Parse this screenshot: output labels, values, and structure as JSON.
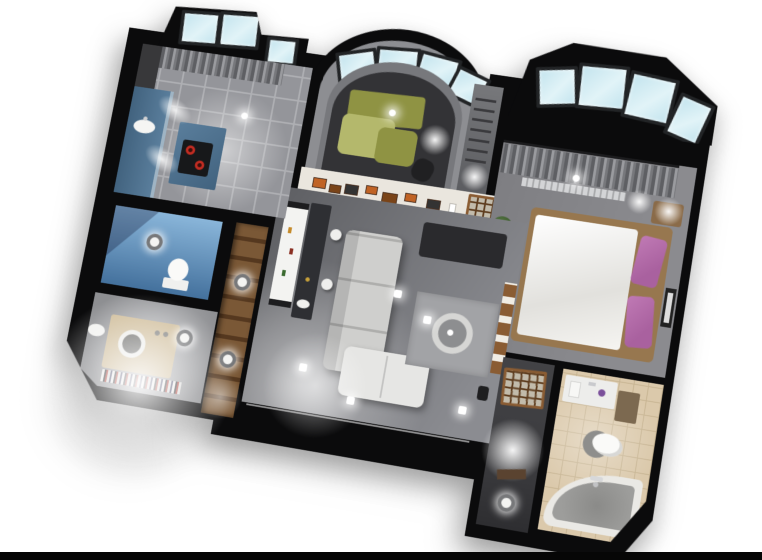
{
  "scene": {
    "type": "3d-apartment-floorplan-render",
    "view": "tilted top-down cutaway",
    "rooms": [
      {
        "id": "kitchen",
        "objects": [
          "window-bay",
          "curtain",
          "blue-cabinets",
          "counter",
          "cooktop-red-burners",
          "sink",
          "tile-floor",
          "ceiling-light"
        ]
      },
      {
        "id": "lounge-bay-room",
        "objects": [
          "curved-bay-window",
          "olive-sofa",
          "desk-chair",
          "lamp",
          "dark-floor"
        ]
      },
      {
        "id": "living-room",
        "objects": [
          "white-credenza",
          "bar-counter",
          "stools",
          "gray-corner-sofa",
          "charcoal-daybed",
          "rug",
          "round-table",
          "shoji-door",
          "art-frames-wall",
          "shelf-unit",
          "ceiling-spotlights"
        ]
      },
      {
        "id": "bedroom",
        "objects": [
          "trapezoid-bay-window",
          "curtain",
          "double-bed",
          "purple-pillows",
          "nightstand",
          "lamp",
          "plant",
          "wall-picture",
          "radiator"
        ]
      },
      {
        "id": "shower-room",
        "objects": [
          "blue-tiled-walls",
          "toilet",
          "ceiling-ring-light"
        ]
      },
      {
        "id": "laundry-room",
        "objects": [
          "washing-machine",
          "sink",
          "shelf-with-items",
          "ceiling-ring-light"
        ]
      },
      {
        "id": "wardrobe-hall",
        "objects": [
          "wood-shelving",
          "ceiling-ring-lights"
        ]
      },
      {
        "id": "bathroom",
        "objects": [
          "vanity-unit",
          "cabinet",
          "toilet",
          "round-mat",
          "corner-bathtub",
          "faucet",
          "beige-tile-floor"
        ]
      },
      {
        "id": "bathroom-hallway",
        "objects": [
          "shoji-screen",
          "dark-floor",
          "light-pool"
        ]
      }
    ]
  },
  "palette": {
    "bg": "#ffffff",
    "wall": "#0b0b0c",
    "glass": "#c3e4ee",
    "glass-frame": "#222426",
    "lounge-wall": "#8d8e92",
    "lounge-floor": "#333336",
    "kitchen-floor": "#94959a",
    "kitchen-grout": "#aeafb3",
    "cabinet-blue": "#5a7e9c",
    "cabinet-blue-dark": "#42637f",
    "counter-dark": "#2e2f33",
    "curtain-a": "#5e5f63",
    "curtain-b": "#9a9b9f",
    "sofa-olive": "#8f9343",
    "sofa-olive-light": "#b4b86c",
    "white-wall": "#eae6de",
    "art-orange": "#c06325",
    "art-brown": "#7a4418",
    "wood": "#8a5c33",
    "wood-dark": "#5e3d1f",
    "shoji-paper": "#c2bbab",
    "living-floor": "#5e5f63",
    "living-floor-light": "#8b8c91",
    "sofa-gray": "#cfcfcd",
    "sofa-gray-light": "#e6e6e4",
    "daybed": "#2a2a2d",
    "rug": "#a2a3a6",
    "bedroom-floor": "#7e7e82",
    "bed-wood": "#97774f",
    "duvet": "#f3f2ef",
    "pillow": "#a9619f",
    "wc-blue": "#44719d",
    "wc-blue-light": "#8ab6da",
    "laundry-floor": "#a7a8aa",
    "appliance-beige": "#cebb97",
    "bath-floor": "#dbc9ab",
    "bath-grout": "#c7b492",
    "tub": "#eae9e5",
    "water": "#9d9d9b",
    "hall-floor": "#3c3c3f",
    "spot": "#ffffff"
  }
}
